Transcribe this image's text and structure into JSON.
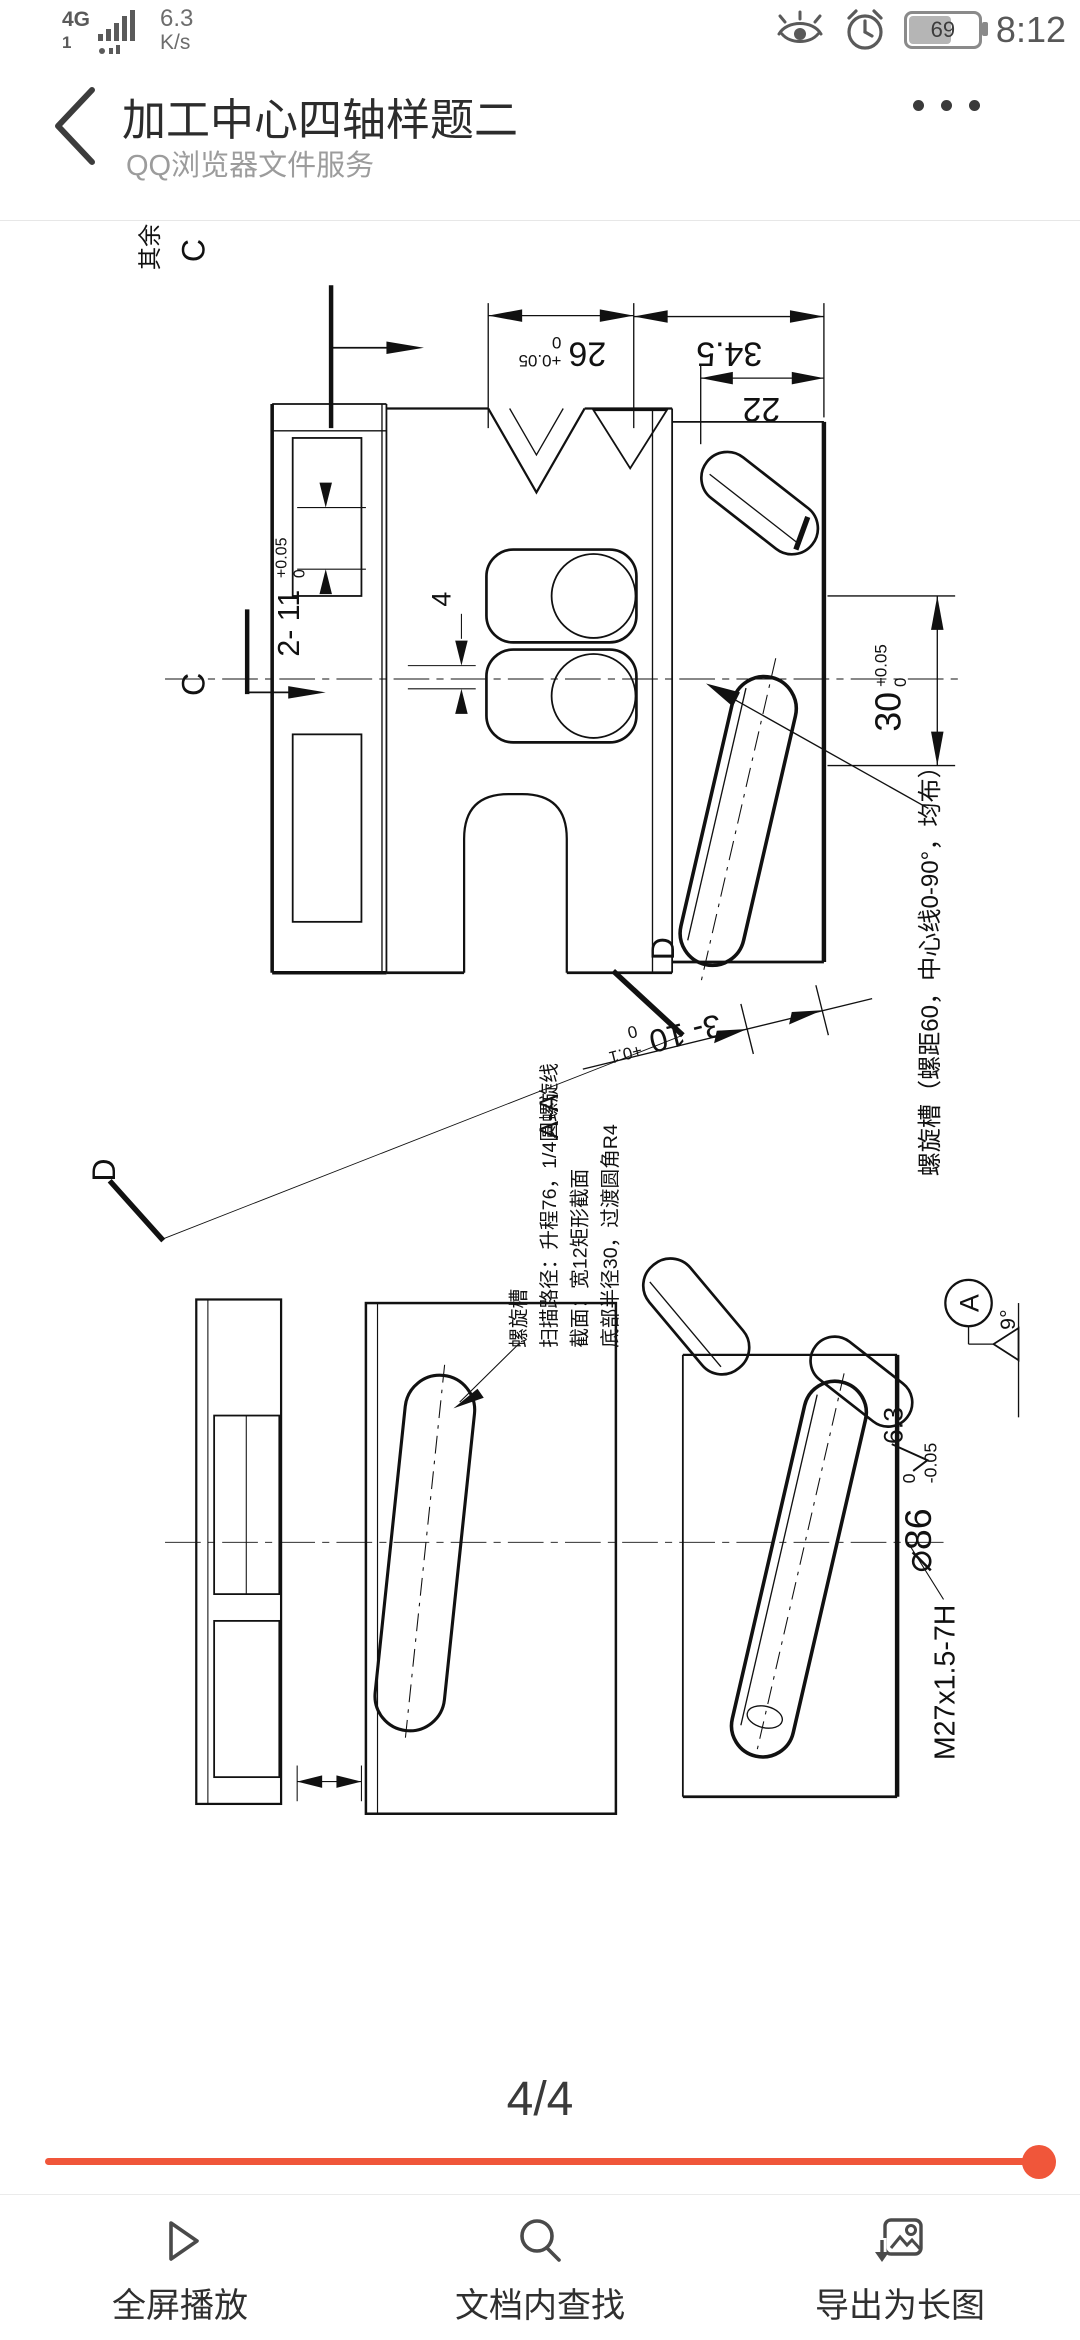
{
  "status_bar": {
    "network": "4G",
    "sim": "1",
    "speed": "6.3",
    "speed_unit": "K/s",
    "battery_percent": "69",
    "time": "8:12"
  },
  "header": {
    "title": "加工中心四轴样题二",
    "subtitle": "QQ浏览器文件服务"
  },
  "drawing": {
    "surface_note": {
      "prefix": "其余",
      "value": "3.2"
    },
    "section_c": "C",
    "section_d": "D",
    "section_aa": "A-A",
    "dim_26": {
      "value": "26",
      "tol_upper": "+0.05",
      "tol_lower": "0"
    },
    "dim_34_5": "34.5",
    "dim_22": "22",
    "dim_4": "4",
    "dim_2x11": {
      "value": "2- 11",
      "tol_upper": "+0.05",
      "tol_lower": "0"
    },
    "dim_30": {
      "value": "30",
      "tol_upper": "+0.05",
      "tol_lower": "0"
    },
    "dim_3x10": {
      "value": "3- 10",
      "tol_upper": "+0.1",
      "tol_lower": "0"
    },
    "helix_note": "螺旋槽（螺距60，中心线0-90°，均布）",
    "spec_note": {
      "line1": "螺旋槽",
      "line2": "扫描路径：升程76，1/4圆螺旋线",
      "line3": "截面：宽12矩形截面",
      "line4": "底部半径30，过渡圆角R4"
    },
    "datum_label": "A",
    "angle_9": "9°",
    "roughness_6_3": "6.3",
    "dia_86": {
      "value": "⌀86",
      "tol_upper": "0",
      "tol_lower": "-0.05"
    },
    "thread": "M27x1.5-7H"
  },
  "pager": {
    "current": "4/4"
  },
  "progress": {
    "color": "#f0563a",
    "position": "end"
  },
  "toolbar": {
    "items": [
      {
        "label": "全屏播放"
      },
      {
        "label": "文档内查找"
      },
      {
        "label": "导出为长图"
      }
    ]
  }
}
